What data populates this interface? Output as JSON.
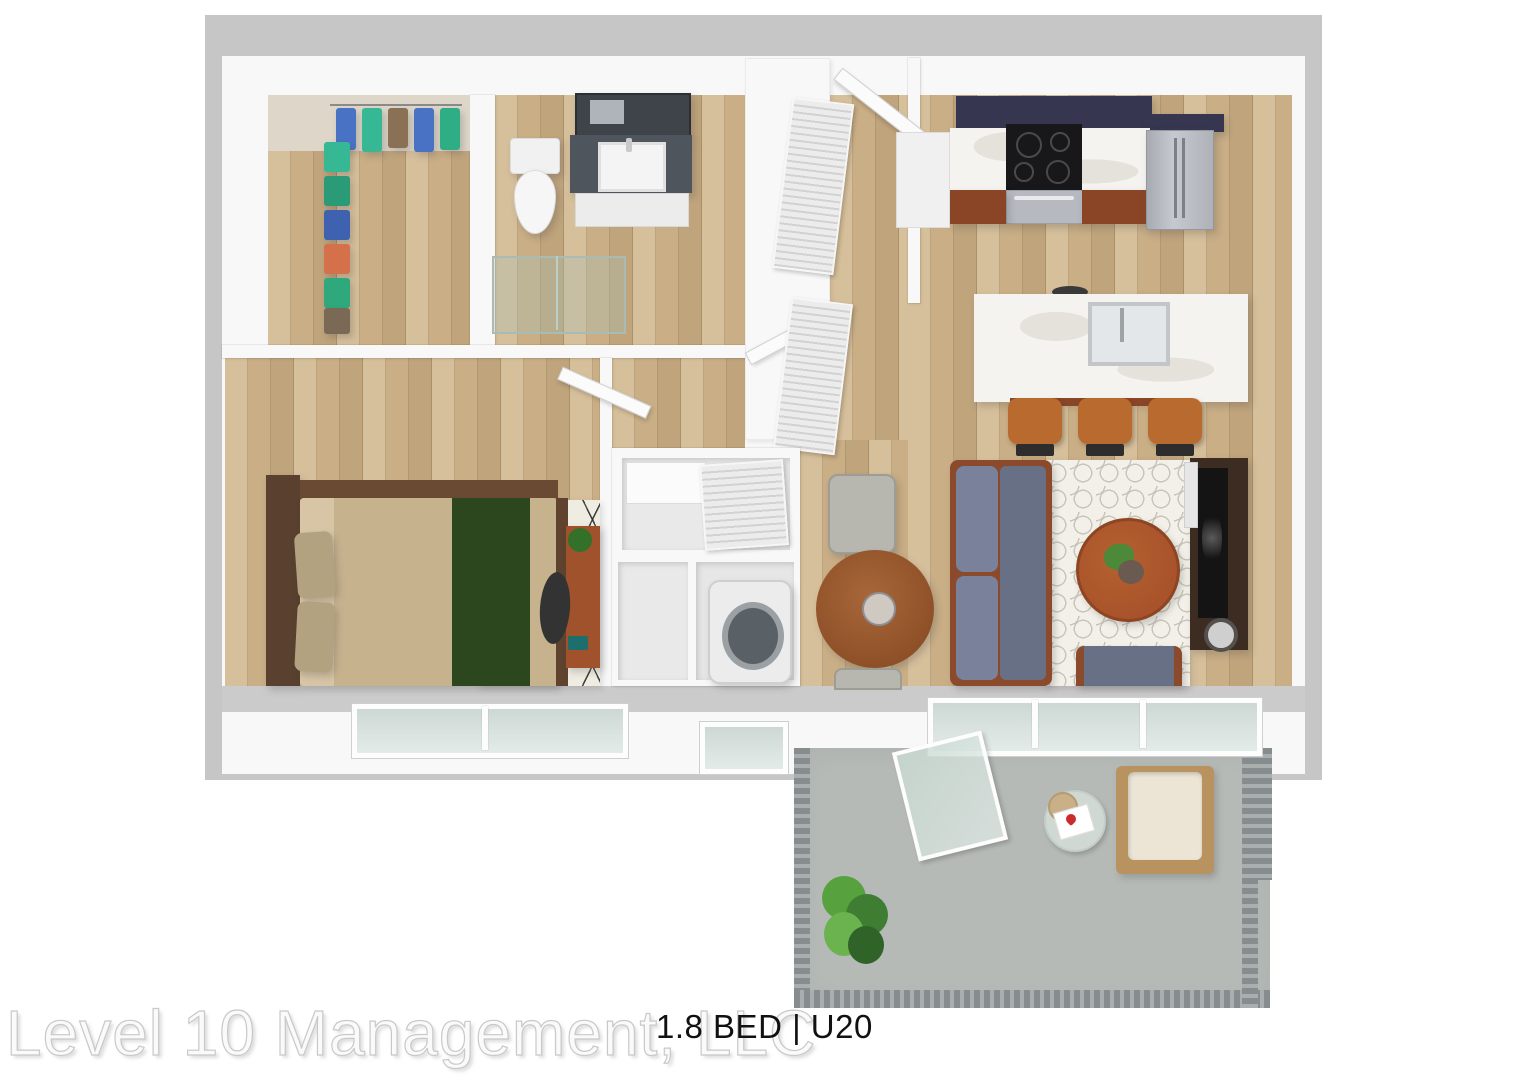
{
  "watermark": {
    "company": "Level 10 Management, LLC"
  },
  "unit_label": {
    "text": "1.8 BED | U20"
  },
  "scene": {
    "type": "3d-floor-plan-render",
    "view": "top-down isometric apartment rendering",
    "rooms": [
      "walk-in closet",
      "bathroom",
      "entry hall",
      "kitchen",
      "living-dining area",
      "bedroom",
      "laundry closet",
      "balcony"
    ],
    "furniture": {
      "walk_in_closet": [
        "hanging clothes on two racks"
      ],
      "bathroom": [
        "toilet",
        "vanity with sink and mirror",
        "glass shower"
      ],
      "kitchen": [
        "dark upper cabinets",
        "marble counter",
        "black cooktop with oven",
        "wood base cabinets",
        "stainless refrigerator",
        "marble island with sink",
        "three bar stools"
      ],
      "living": [
        "gray sofa",
        "trellis rug",
        "round coffee table with plant",
        "media console with tv and speaker",
        "armchair"
      ],
      "dining": [
        "round wood table",
        "two gray chairs"
      ],
      "bedroom": [
        "wood bed with tan duvet and green runner",
        "two pillows",
        "black and white diamond rug",
        "desk with chair and plant"
      ],
      "laundry_closet": [
        "washer",
        "louvered doors"
      ],
      "balcony": [
        "concrete floor",
        "metal railing",
        "potted plant",
        "wood lounge chair with white cushion",
        "glass side table with book and hat",
        "open sliding glass door"
      ]
    }
  },
  "colors": {
    "wall": "#f8f8f8",
    "wallEdge": "#c6c6c6",
    "wallBand": "#cbcbcb",
    "wood1": "#d6bf9b",
    "wood2": "#c9ae86",
    "wood3": "#bfa47c",
    "concrete": "#b6bab7",
    "railing": "#878d8f",
    "marble": "#f4f3ef",
    "marbleVein": "#e4e2da",
    "cabinetDark": "#363650",
    "cabinetWood": "#8a4527",
    "stainless": "#b6bac0",
    "cooktop": "#18181a",
    "sofa": "#687085",
    "sofaLight": "#79819b",
    "woodFurniture": "#a8532b",
    "woodFrame": "#8a4a2b",
    "rugCream": "#f2f0e8",
    "rugLine": "#c8c5b8",
    "bedTan": "#c7b28e",
    "bedTanLight": "#d7c5a5",
    "bedGreen": "#2c471e",
    "headboard": "#59402f",
    "pillow": "#b3a27f",
    "console": "#3c2c21",
    "tv": "#141414",
    "chairGray": "#b7b7af",
    "stool": "#b96b2f",
    "plantGreen": "#4c8a39",
    "plantDark": "#33702a",
    "deskWood": "#a0522d",
    "washerRing": "#9aa0a3",
    "watermark": "#fafafa",
    "watermarkStroke": "#c9c9c9",
    "blackText": "#111111"
  }
}
